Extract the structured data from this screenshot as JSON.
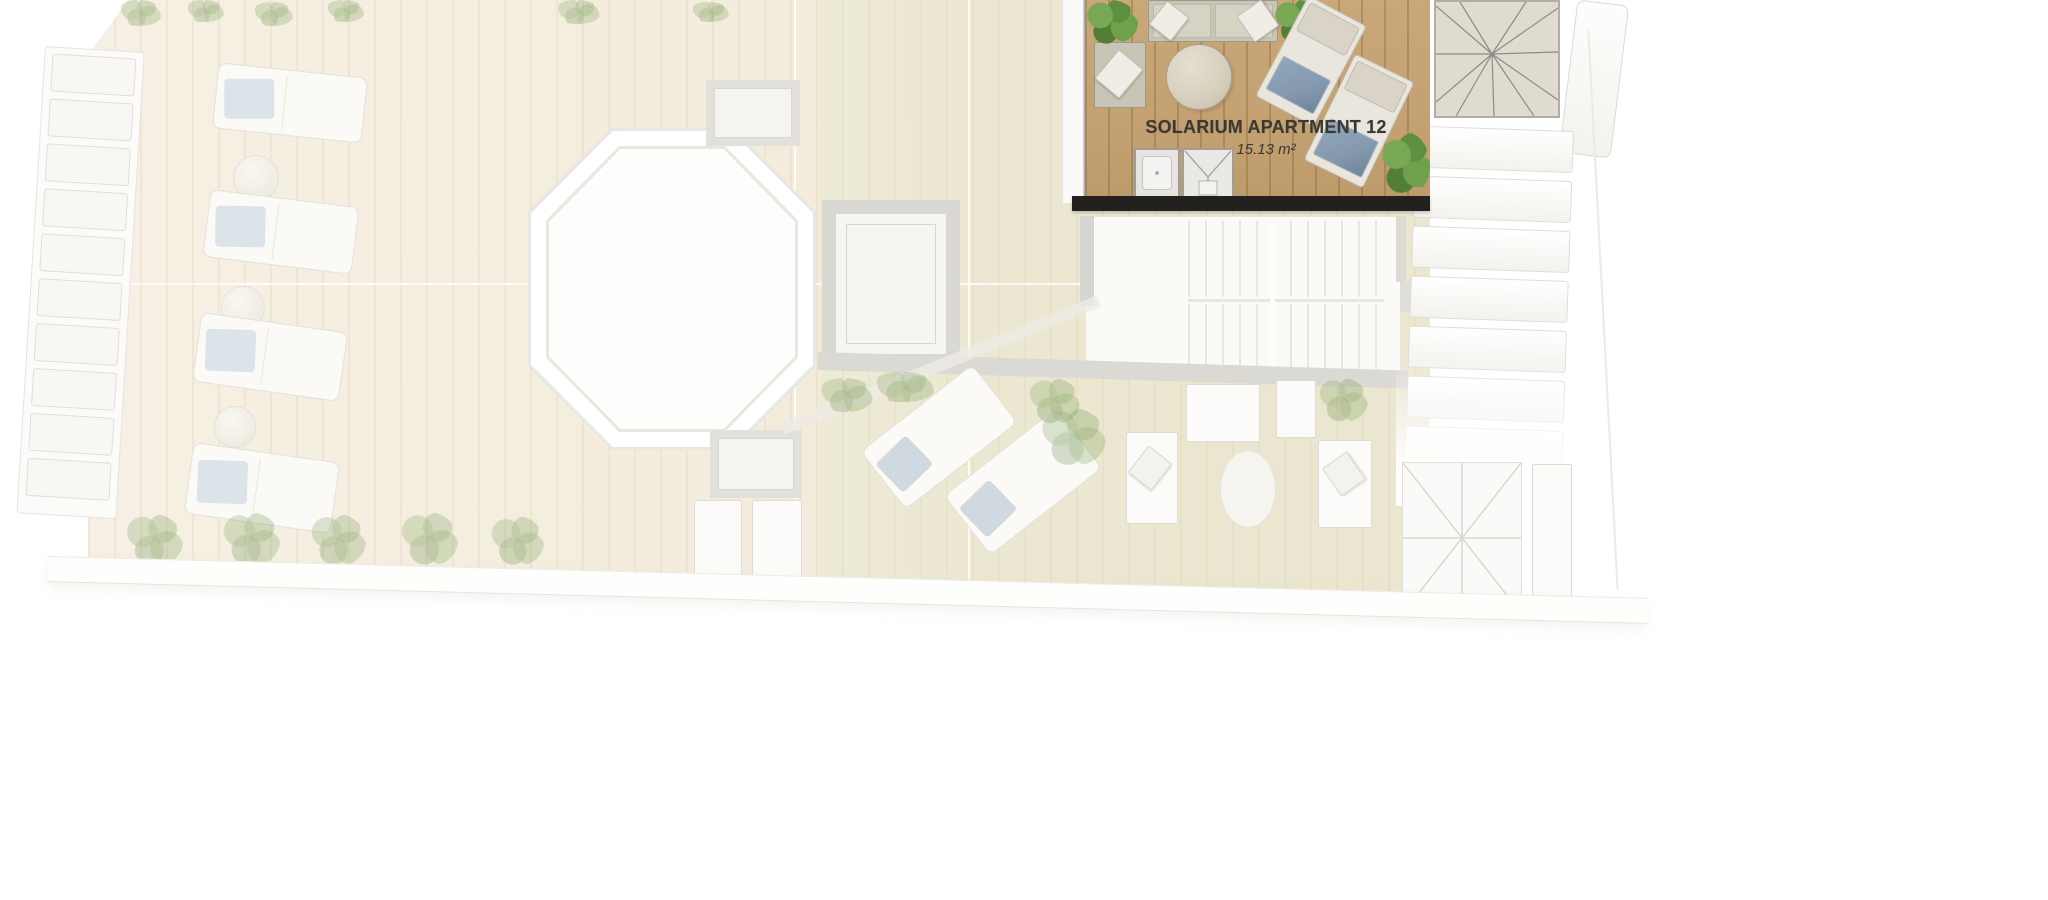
{
  "plan": {
    "apartment": {
      "title": "SOLARIUM APARTMENT 12",
      "area": "15.13 m²"
    },
    "colors": {
      "deck_wood": "#c9a778",
      "wall_dark": "#22211f",
      "towel_blue": "#8499ad",
      "sofa_gray": "#c9c5b6",
      "label_text": "#3b3833",
      "floor_cream": "#f3ecdc",
      "plant_green": "#6fa14c"
    }
  }
}
